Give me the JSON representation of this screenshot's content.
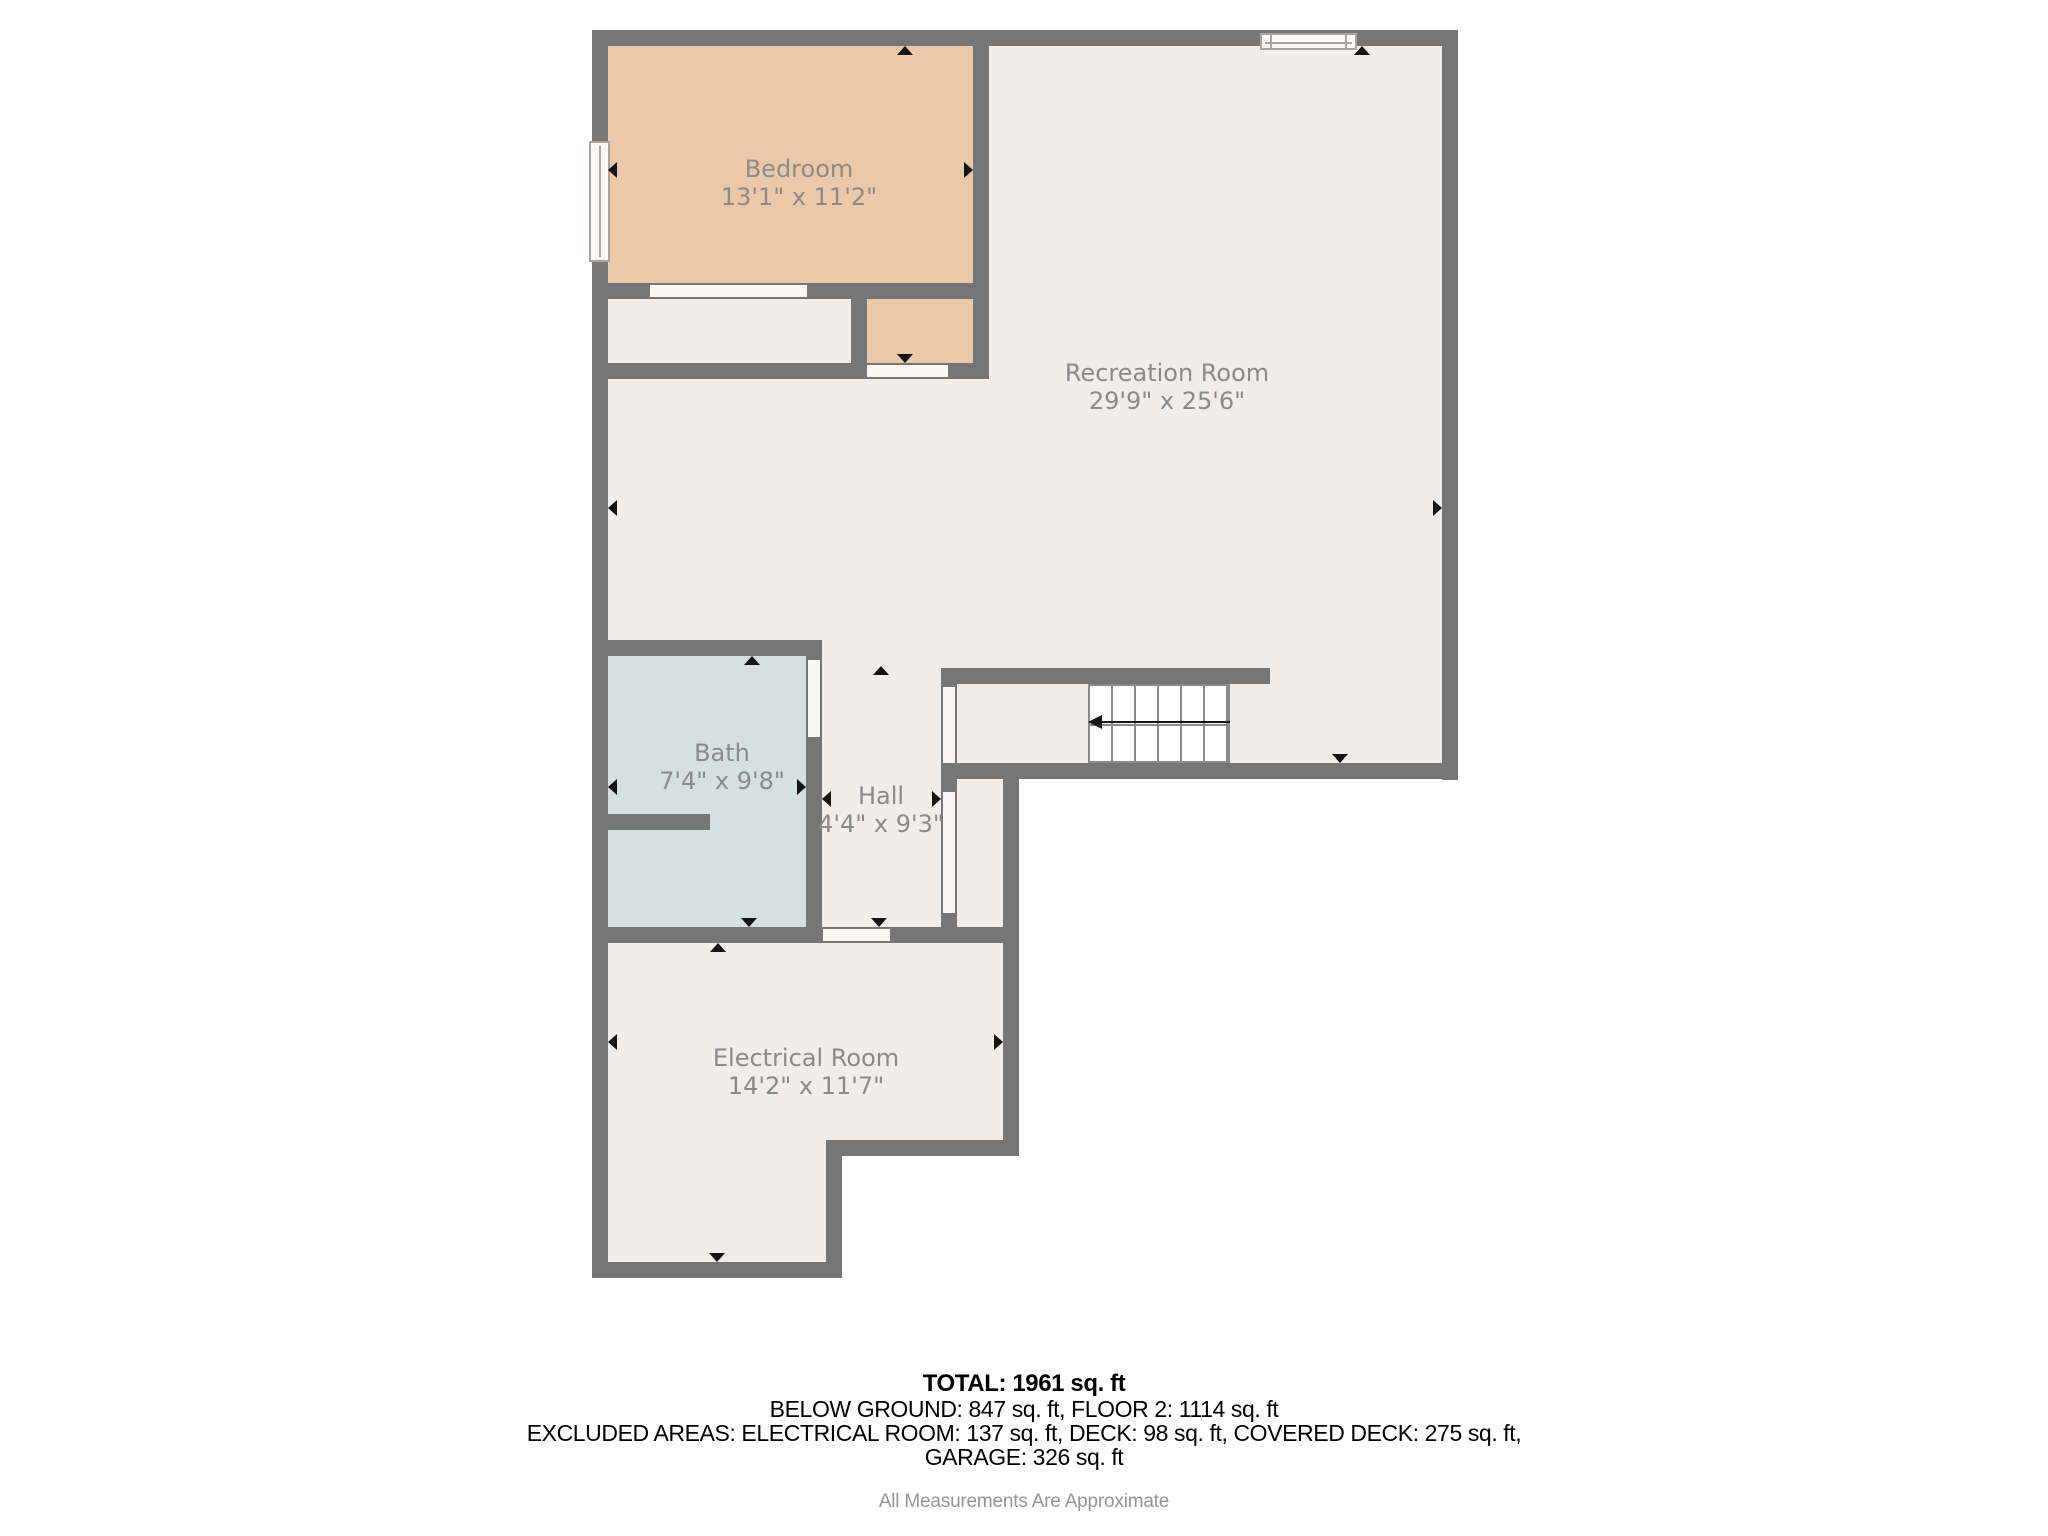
{
  "plan": {
    "title": "Basement floor plan",
    "rooms": [
      {
        "name": "Bedroom",
        "dims": "13'1\" x 11'2\""
      },
      {
        "name": "Recreation Room",
        "dims": "29'9\" x 25'6\""
      },
      {
        "name": "Bath",
        "dims": "7'4\" x 9'8\""
      },
      {
        "name": "Hall",
        "dims": "4'4\" x 9'3\""
      },
      {
        "name": "Electrical Room",
        "dims": "14'2\" x 11'7\""
      }
    ],
    "colors": {
      "wall": "#767676",
      "floor": "#f4ece7",
      "bedroom": "#ebc9a8",
      "bath": "#d5e1e1",
      "opening": "#faf6f2",
      "label": "#8a8a8a"
    }
  },
  "summary": {
    "total": "TOTAL: 1961 sq. ft",
    "areas": "BELOW GROUND: 847 sq. ft, FLOOR 2: 1114 sq. ft",
    "excluded": "EXCLUDED AREAS: ELECTRICAL ROOM: 137 sq. ft, DECK: 98 sq. ft, COVERED DECK: 275 sq. ft,",
    "excluded2": "GARAGE: 326 sq. ft",
    "disclaimer": "All Measurements Are Approximate"
  }
}
